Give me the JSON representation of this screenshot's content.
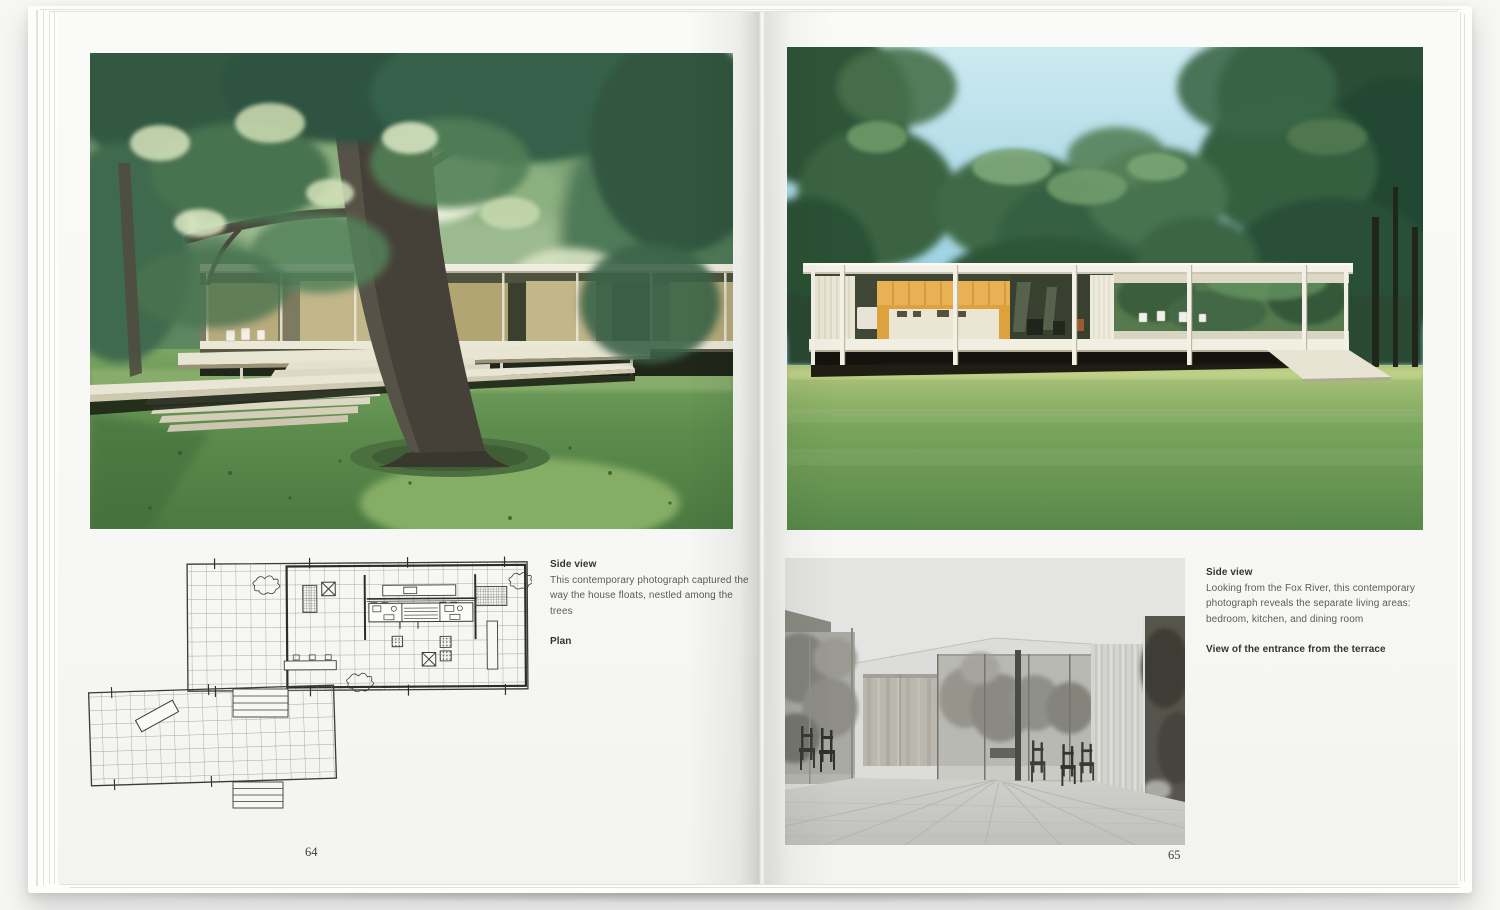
{
  "book": {
    "left_page": {
      "page_number": "64",
      "captions": {
        "photo_title": "Side view",
        "photo_body": "This contemporary photograph captured the way the house floats, nestled among the trees",
        "plan_title": "Plan"
      }
    },
    "right_page": {
      "page_number": "65",
      "captions": {
        "photo_title": "Side view",
        "photo_body": "Looking from the Fox River, this contemporary photograph reveals the separate living areas: bedroom, kitchen, and dining room",
        "interior_title": "View of the entrance from the terrace"
      }
    },
    "images": {
      "left_photo": "farnsworth-house-through-trees-photo",
      "right_photo": "farnsworth-house-side-elevation-photo",
      "plan": "farnsworth-house-floor-plan-drawing",
      "interior_photo": "interior-view-black-and-white-photo"
    },
    "colors": {
      "sky": "#9fd2e2",
      "lawn": "#6a9a55",
      "foliage": "#3c6349",
      "kitchen_core": "#dfa33f",
      "paper": "#f8f8f6"
    }
  }
}
